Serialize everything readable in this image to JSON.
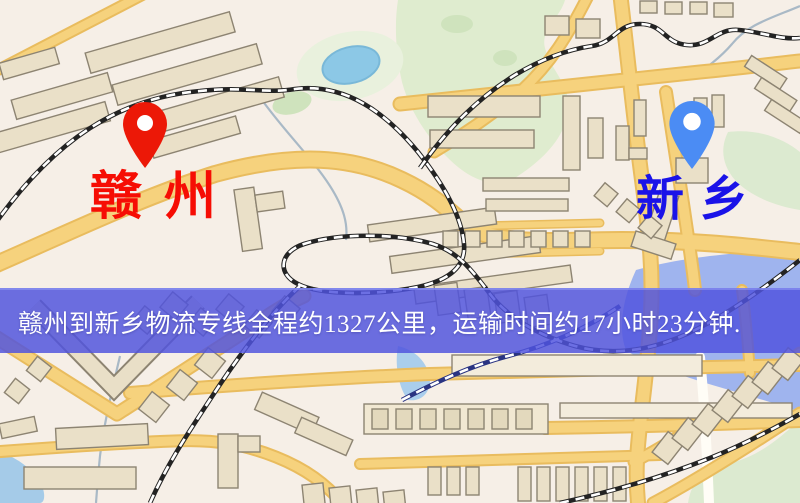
{
  "banner": {
    "text": "赣州到新乡物流专线全程约1327公里，运输时间约17小时23分钟.",
    "background_color": "#5054de",
    "text_color": "#ffffff"
  },
  "route": {
    "origin": "赣州",
    "destination": "新乡",
    "distance": "约1327公里",
    "duration": "约17小时23分钟"
  },
  "markers": {
    "origin": {
      "name": "赣州",
      "pin_color": "#ec1807",
      "label_color": "#f60d04"
    },
    "destination": {
      "name": "新乡",
      "pin_color": "#4b8cf4",
      "label_color": "#1a13e8"
    }
  },
  "map_palette": {
    "background": "#f6efe7",
    "road_fill": "#f6d27d",
    "road_edge": "#e9bc5e",
    "building_fill": "#eae0c8",
    "building_edge": "#8d8472",
    "green_area": "#dcead0",
    "park_light": "#e9f1dd",
    "water_lavender": "#9fb4ee",
    "pond_blue": "#8cc8e6",
    "railway_dark": "#232323",
    "railway_water": "#2a3482"
  }
}
